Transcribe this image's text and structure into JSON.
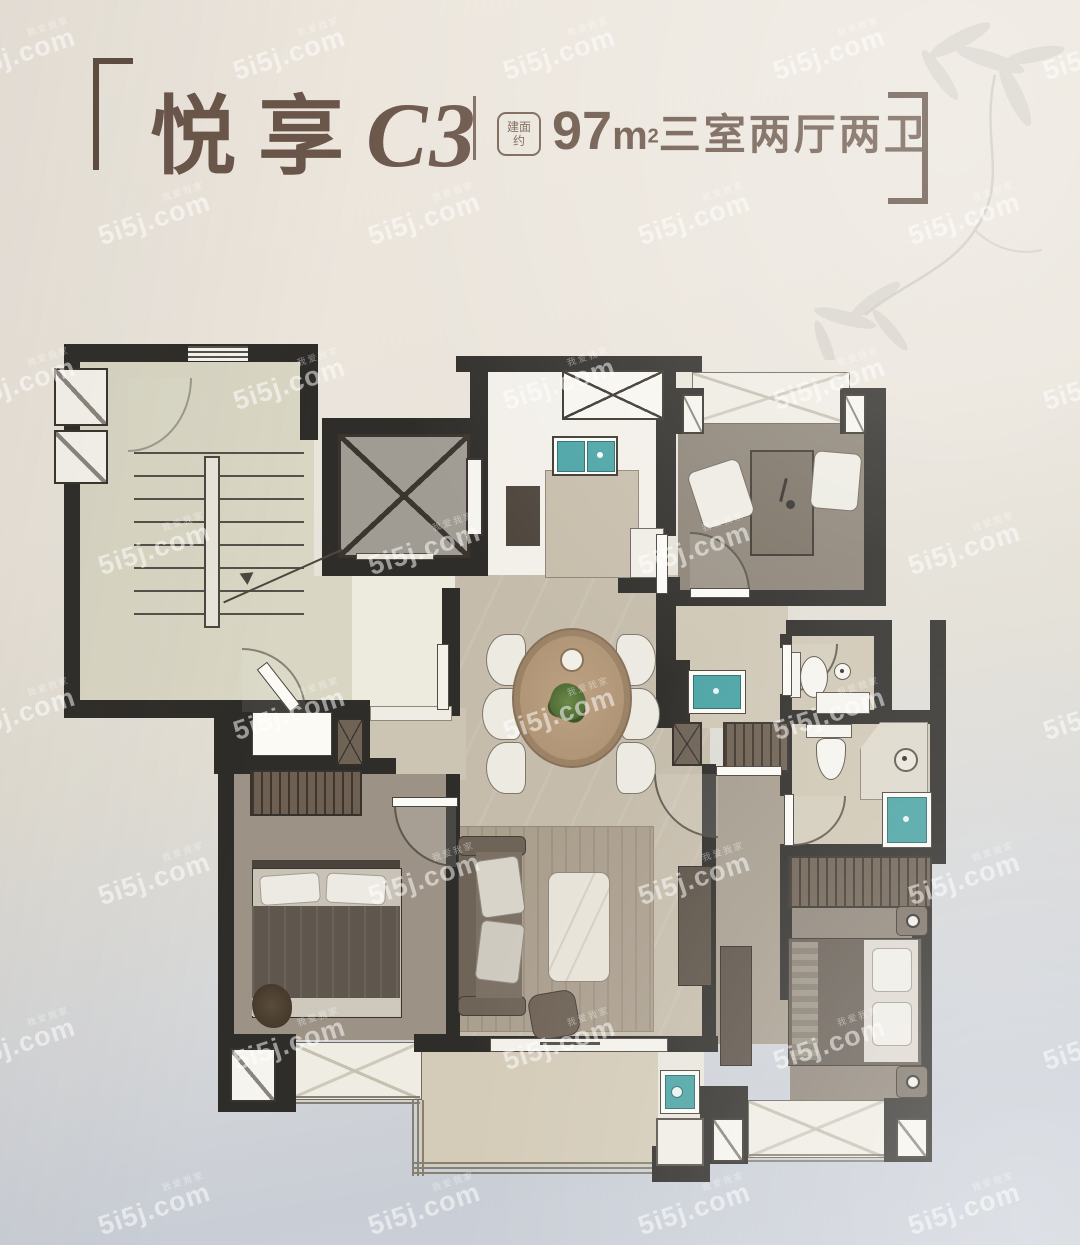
{
  "header": {
    "title_cn": "悦享",
    "title_code": "C3",
    "badge_line1": "建面",
    "badge_line2": "约",
    "area_value": "97",
    "area_unit": "m",
    "area_sup": "2",
    "layout_text": "三室两厅两卫"
  },
  "watermark": {
    "text": "5i5j.com",
    "subtext": "我爱我家"
  },
  "colors": {
    "accent_brown": "#6b564a",
    "wall_dark": "#2f2d29",
    "teal_fixture": "#4aa3a4",
    "paper_top": "#ece6dd",
    "paper_bottom": "#c9ced6"
  }
}
